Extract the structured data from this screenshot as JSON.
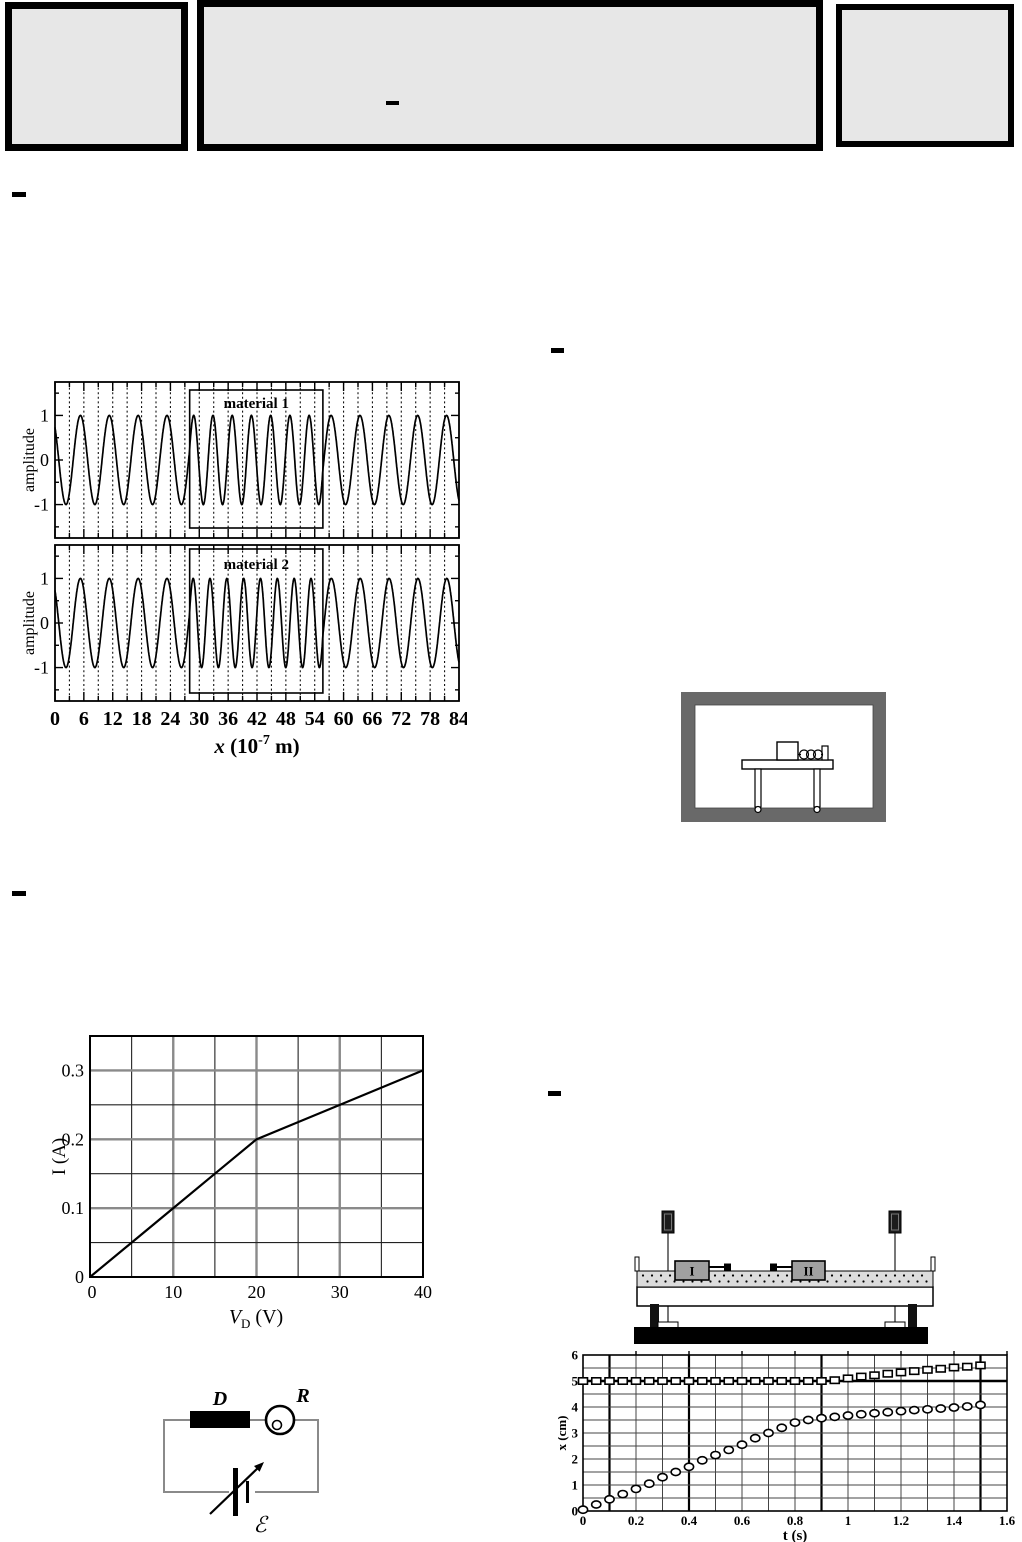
{
  "header_boxes": {
    "fill": "#e7e7e7",
    "border_color": "#000000",
    "middle_box_dash": "–"
  },
  "dash_marks": {
    "glyph": "–",
    "count": 4
  },
  "diagrams": {
    "room_with_table": {
      "frame_color": "#696969",
      "elements": [
        "room-frame",
        "table",
        "table-legs",
        "block-on-table",
        "spring",
        "end-post"
      ]
    },
    "circuit": {
      "device_label": "D",
      "meter_label": "R",
      "emf_label": "ℰ",
      "elements": [
        "loop-wire",
        "black-device-box",
        "bulb-meter-circle",
        "variable-battery",
        "arrow"
      ]
    },
    "airtrack": {
      "cart_labels": [
        "I",
        "II"
      ],
      "elements": [
        "photogate-left",
        "photogate-right",
        "air-track",
        "cart-I",
        "cart-II",
        "bumpers",
        "supports",
        "black-base"
      ]
    }
  },
  "chart_data": [
    {
      "id": "wave-materials",
      "type": "line",
      "title": "",
      "xlabel": "x (10⁻⁷ m)",
      "xlabel_parts": {
        "pre_italic": "x",
        "mid": " (10",
        "sup": "-7",
        "post": " m)"
      },
      "ylabel": "amplitude",
      "xlim": [
        0,
        84
      ],
      "ylim": [
        -1.75,
        1.75
      ],
      "xticks": [
        0,
        6,
        12,
        18,
        24,
        30,
        36,
        42,
        48,
        54,
        60,
        66,
        72,
        78,
        84
      ],
      "ytick_labels": [
        "1",
        "0",
        "-1"
      ],
      "yticks": [
        1,
        0,
        -1
      ],
      "minor_x_every": 3,
      "dashed_grid_every": 3,
      "amplitude": 1,
      "wavelength_outside": 6,
      "material_region_x": [
        28,
        55.7
      ],
      "phase_offset_rad": 0.75,
      "panels": [
        {
          "label": "material 1",
          "wavelength_inside": 4
        },
        {
          "label": "material 2",
          "wavelength_inside": 3.5
        }
      ]
    },
    {
      "id": "diode-iv",
      "type": "line",
      "xlabel": "V_D (V)",
      "xlabel_parts": {
        "pre_italic": "V",
        "sub": "D",
        "post": " (V)"
      },
      "ylabel": "I (A)",
      "xlim": [
        0,
        40
      ],
      "ylim": [
        0,
        0.35
      ],
      "xticks": [
        0,
        10,
        20,
        30,
        40
      ],
      "ytick_labels": [
        "0",
        "0.1",
        "0.2",
        "0.3"
      ],
      "yticks": [
        0,
        0.1,
        0.2,
        0.3
      ],
      "grid_x_every": 5,
      "grid_y_every": 0.05,
      "x": [
        0,
        5,
        10,
        15,
        20,
        25,
        30,
        35,
        40
      ],
      "y": [
        0,
        0.05,
        0.1,
        0.15,
        0.2,
        0.225,
        0.25,
        0.275,
        0.3
      ]
    },
    {
      "id": "carts-position-time",
      "type": "scatter",
      "xlabel": "t (s)",
      "ylabel": "x (cm)",
      "xlim": [
        0,
        1.6
      ],
      "ylim": [
        0,
        6
      ],
      "xtick_labels": [
        "0",
        "0.2",
        "0.4",
        "0.6",
        "0.8",
        "1",
        "1.2",
        "1.4",
        "1.6"
      ],
      "xticks": [
        0,
        0.2,
        0.4,
        0.6,
        0.8,
        1,
        1.2,
        1.4,
        1.6
      ],
      "yticks": [
        0,
        1,
        2,
        3,
        4,
        5,
        6
      ],
      "grid_x_every": 0.1,
      "grid_y_every": 0.5,
      "bold_vlines": [
        0.1,
        0.4,
        0.9,
        1.5
      ],
      "bold_hline": 5,
      "series": [
        {
          "name": "cart I",
          "marker": "circle",
          "t": [
            0,
            0.05,
            0.1,
            0.15,
            0.2,
            0.25,
            0.3,
            0.35,
            0.4,
            0.45,
            0.5,
            0.55,
            0.6,
            0.65,
            0.7,
            0.75,
            0.8,
            0.85,
            0.9,
            0.95,
            1,
            1.05,
            1.1,
            1.15,
            1.2,
            1.25,
            1.3,
            1.35,
            1.4,
            1.45,
            1.5
          ],
          "x": [
            0.05,
            0.25,
            0.45,
            0.65,
            0.85,
            1.05,
            1.3,
            1.5,
            1.7,
            1.95,
            2.15,
            2.35,
            2.55,
            2.8,
            3.0,
            3.2,
            3.4,
            3.5,
            3.57,
            3.62,
            3.67,
            3.72,
            3.76,
            3.8,
            3.84,
            3.88,
            3.91,
            3.94,
            3.98,
            4.02,
            4.08
          ]
        },
        {
          "name": "cart II",
          "marker": "square",
          "t": [
            0,
            0.05,
            0.1,
            0.15,
            0.2,
            0.25,
            0.3,
            0.35,
            0.4,
            0.45,
            0.5,
            0.55,
            0.6,
            0.65,
            0.7,
            0.75,
            0.8,
            0.85,
            0.9,
            0.95,
            1,
            1.05,
            1.1,
            1.15,
            1.2,
            1.25,
            1.3,
            1.35,
            1.4,
            1.45,
            1.5
          ],
          "x": [
            5,
            5,
            5,
            5,
            5,
            5,
            5,
            5,
            5,
            5,
            5,
            5,
            5,
            5,
            5,
            5,
            5,
            5,
            5,
            5.03,
            5.1,
            5.17,
            5.22,
            5.28,
            5.33,
            5.38,
            5.43,
            5.47,
            5.52,
            5.55,
            5.6
          ]
        }
      ]
    }
  ]
}
